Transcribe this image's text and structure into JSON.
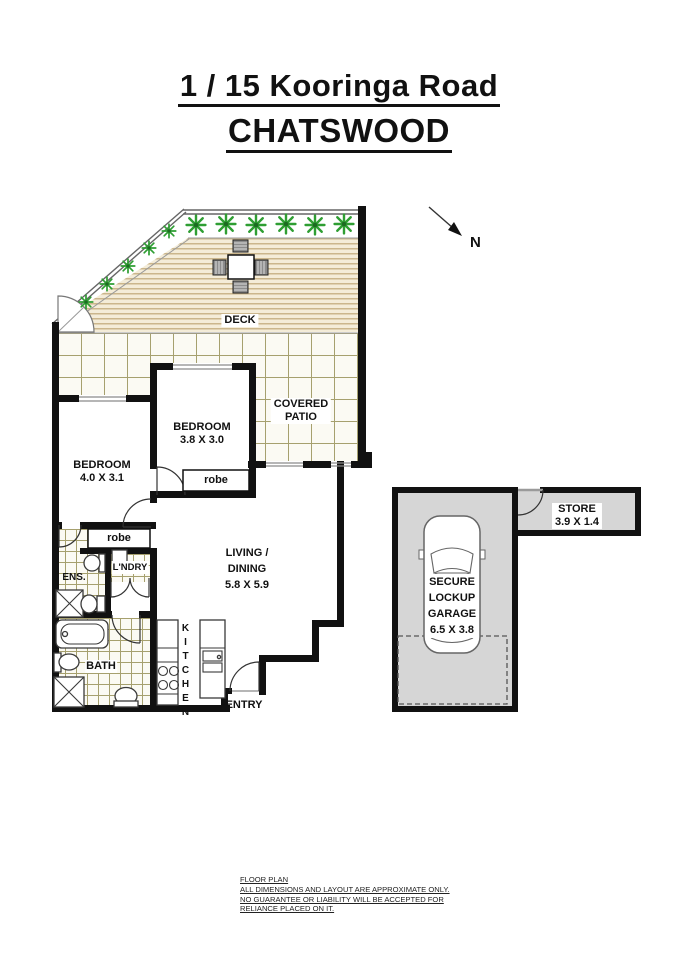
{
  "title": {
    "line1": "1 / 15 Kooringa Road",
    "line2": "CHATSWOOD"
  },
  "compass": {
    "north": "N"
  },
  "unit": {
    "deck": "DECK",
    "covered_patio": {
      "line1": "COVERED",
      "line2": "PATIO"
    },
    "bedroom_main": {
      "name": "BEDROOM",
      "dims": "4.0 X 3.1"
    },
    "bedroom_two": {
      "name": "BEDROOM",
      "dims": "3.8 X 3.0"
    },
    "robe_bedroom": "robe",
    "robe_hall": "robe",
    "ensuite": "ENS.",
    "laundry": "L'NDRY",
    "bath": "BATH",
    "kitchen": "KITCHEN",
    "living": {
      "line1": "LIVING /",
      "line2": "DINING",
      "dims": "5.8 X 5.9"
    },
    "entry": "ENTRY"
  },
  "garage": {
    "label": {
      "line1": "SECURE",
      "line2": "LOCKUP",
      "line3": "GARAGE",
      "dims": "6.5 X 3.8"
    },
    "store": {
      "name": "STORE",
      "dims": "3.9 X 1.4"
    }
  },
  "footer": {
    "line1": "FLOOR PLAN",
    "line2": "ALL DIMENSIONS AND LAYOUT ARE APPROXIMATE ONLY.",
    "line3": "NO GUARANTEE OR LIABILITY WILL BE ACCEPTED FOR",
    "line4": "RELIANCE PLACED ON IT."
  },
  "colors": {
    "wall": "#111111",
    "outline": "#666666",
    "deck_board": "#cbb68c",
    "deck_bg": "#f4ecd8",
    "tile_line": "#a6a06e",
    "tile_bg": "#fbfaf3",
    "garage_fill": "#d6d6d6",
    "plant": "#2f9e33",
    "plant_dark": "#1d6b22",
    "fixture": "#3a3a3a"
  }
}
